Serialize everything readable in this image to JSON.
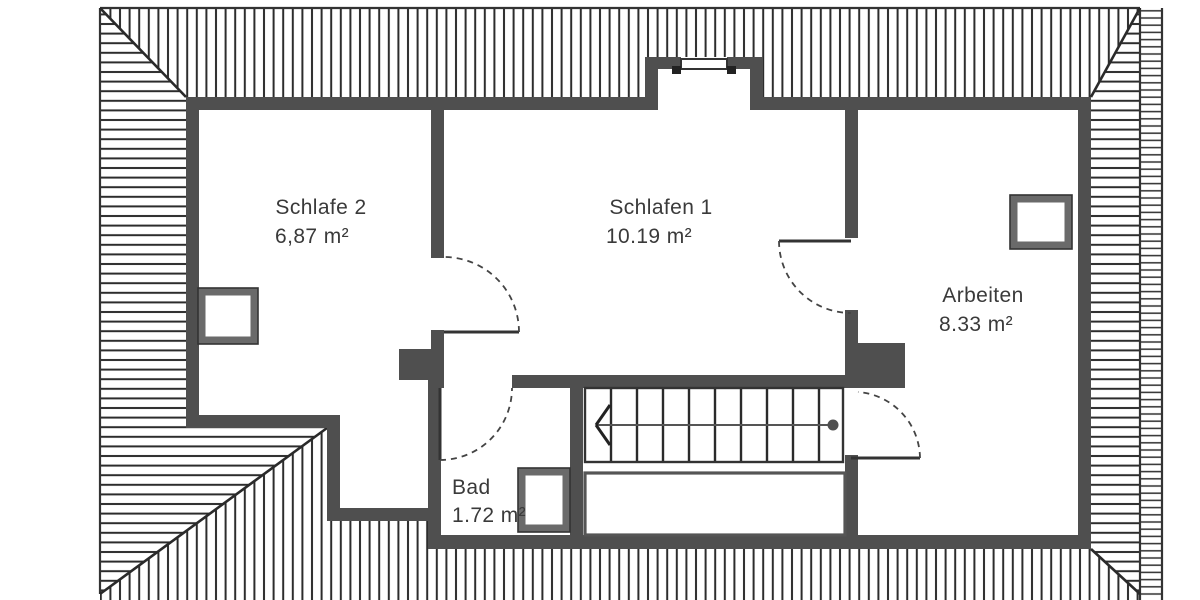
{
  "plan": {
    "type": "attic floor plan",
    "rooms": [
      {
        "name": "Schlafe 2",
        "area": "6,87 m²"
      },
      {
        "name": "Schlafen 1",
        "area": "10.19 m²"
      },
      {
        "name": "Arbeiten",
        "area": "8.33 m²"
      },
      {
        "name": "Bad",
        "area": "1.72 m²"
      }
    ],
    "symbols": {
      "roof_hatching_icon": "parallel-line roof slope hatching",
      "hip_line_icon": "diagonal roof hip line",
      "door_swing_icon": "quarter-circle door swing arc",
      "skylight_icon": "roof-window rectangle",
      "stair_icon": "staircase with treads",
      "stair_direction_icon": "walk-line arrow with start dot",
      "dormer_window_icon": "dormer window double line",
      "chimney_icon": "solid filled masonry block"
    },
    "colors": {
      "wall": "#4f4f4f",
      "hatch_line": "#2c2c2c",
      "thin_line": "#333333",
      "window_frame": "#6a6a6a",
      "text": "#3a3a3a",
      "background": "#ffffff"
    }
  }
}
